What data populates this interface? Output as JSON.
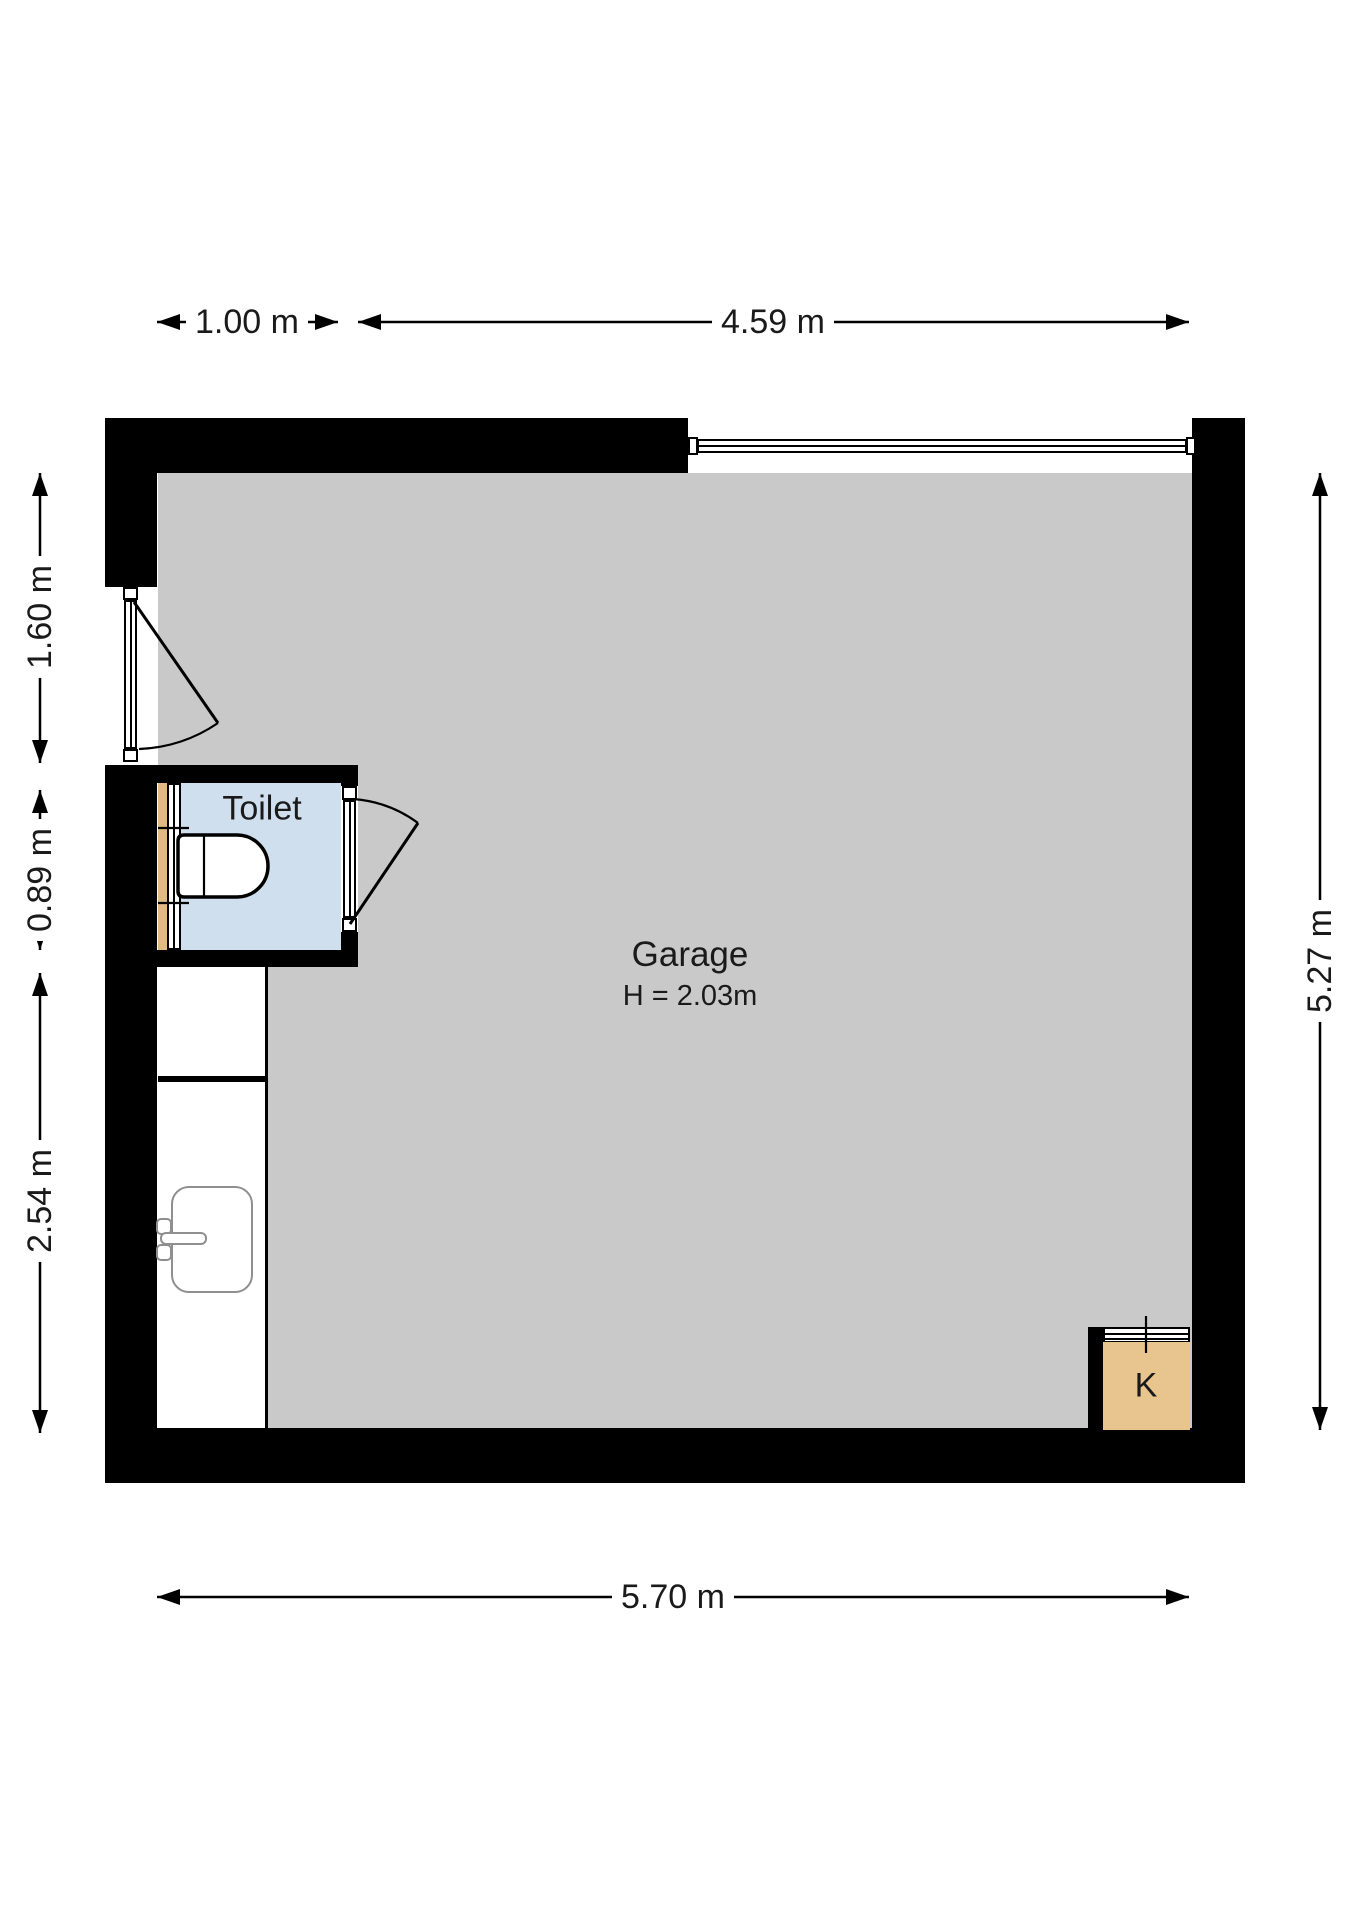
{
  "plan": {
    "type": "floorplan",
    "rooms": [
      {
        "name": "garage",
        "label": "Garage",
        "height_label": "H = 2.03m"
      },
      {
        "name": "toilet",
        "label": "Toilet"
      },
      {
        "name": "closet",
        "label": "K"
      }
    ],
    "fixtures": [
      "toilet-bowl",
      "sink",
      "faucet",
      "window",
      "vent-grille"
    ],
    "doors": [
      "entry-door-left-wall",
      "toilet-door",
      "garage-overhead-door-top-wall"
    ],
    "dimensions": {
      "top": [
        {
          "label": "1.00 m"
        },
        {
          "label": "4.59 m"
        }
      ],
      "left": [
        {
          "label": "1.60 m"
        },
        {
          "label": "0.89 m"
        },
        {
          "label": "2.54 m"
        }
      ],
      "right": [
        {
          "label": "5.27 m"
        }
      ],
      "bottom": [
        {
          "label": "5.70 m"
        }
      ]
    },
    "colors": {
      "wall": "#000000",
      "floor": "#c9c9c9",
      "toilet_floor": "#cfdfee",
      "closet_fill": "#e8c48f",
      "window_sill": "#e2b983",
      "fixture_outline": "#8f8f8f",
      "text": "#1a1a1a"
    }
  }
}
